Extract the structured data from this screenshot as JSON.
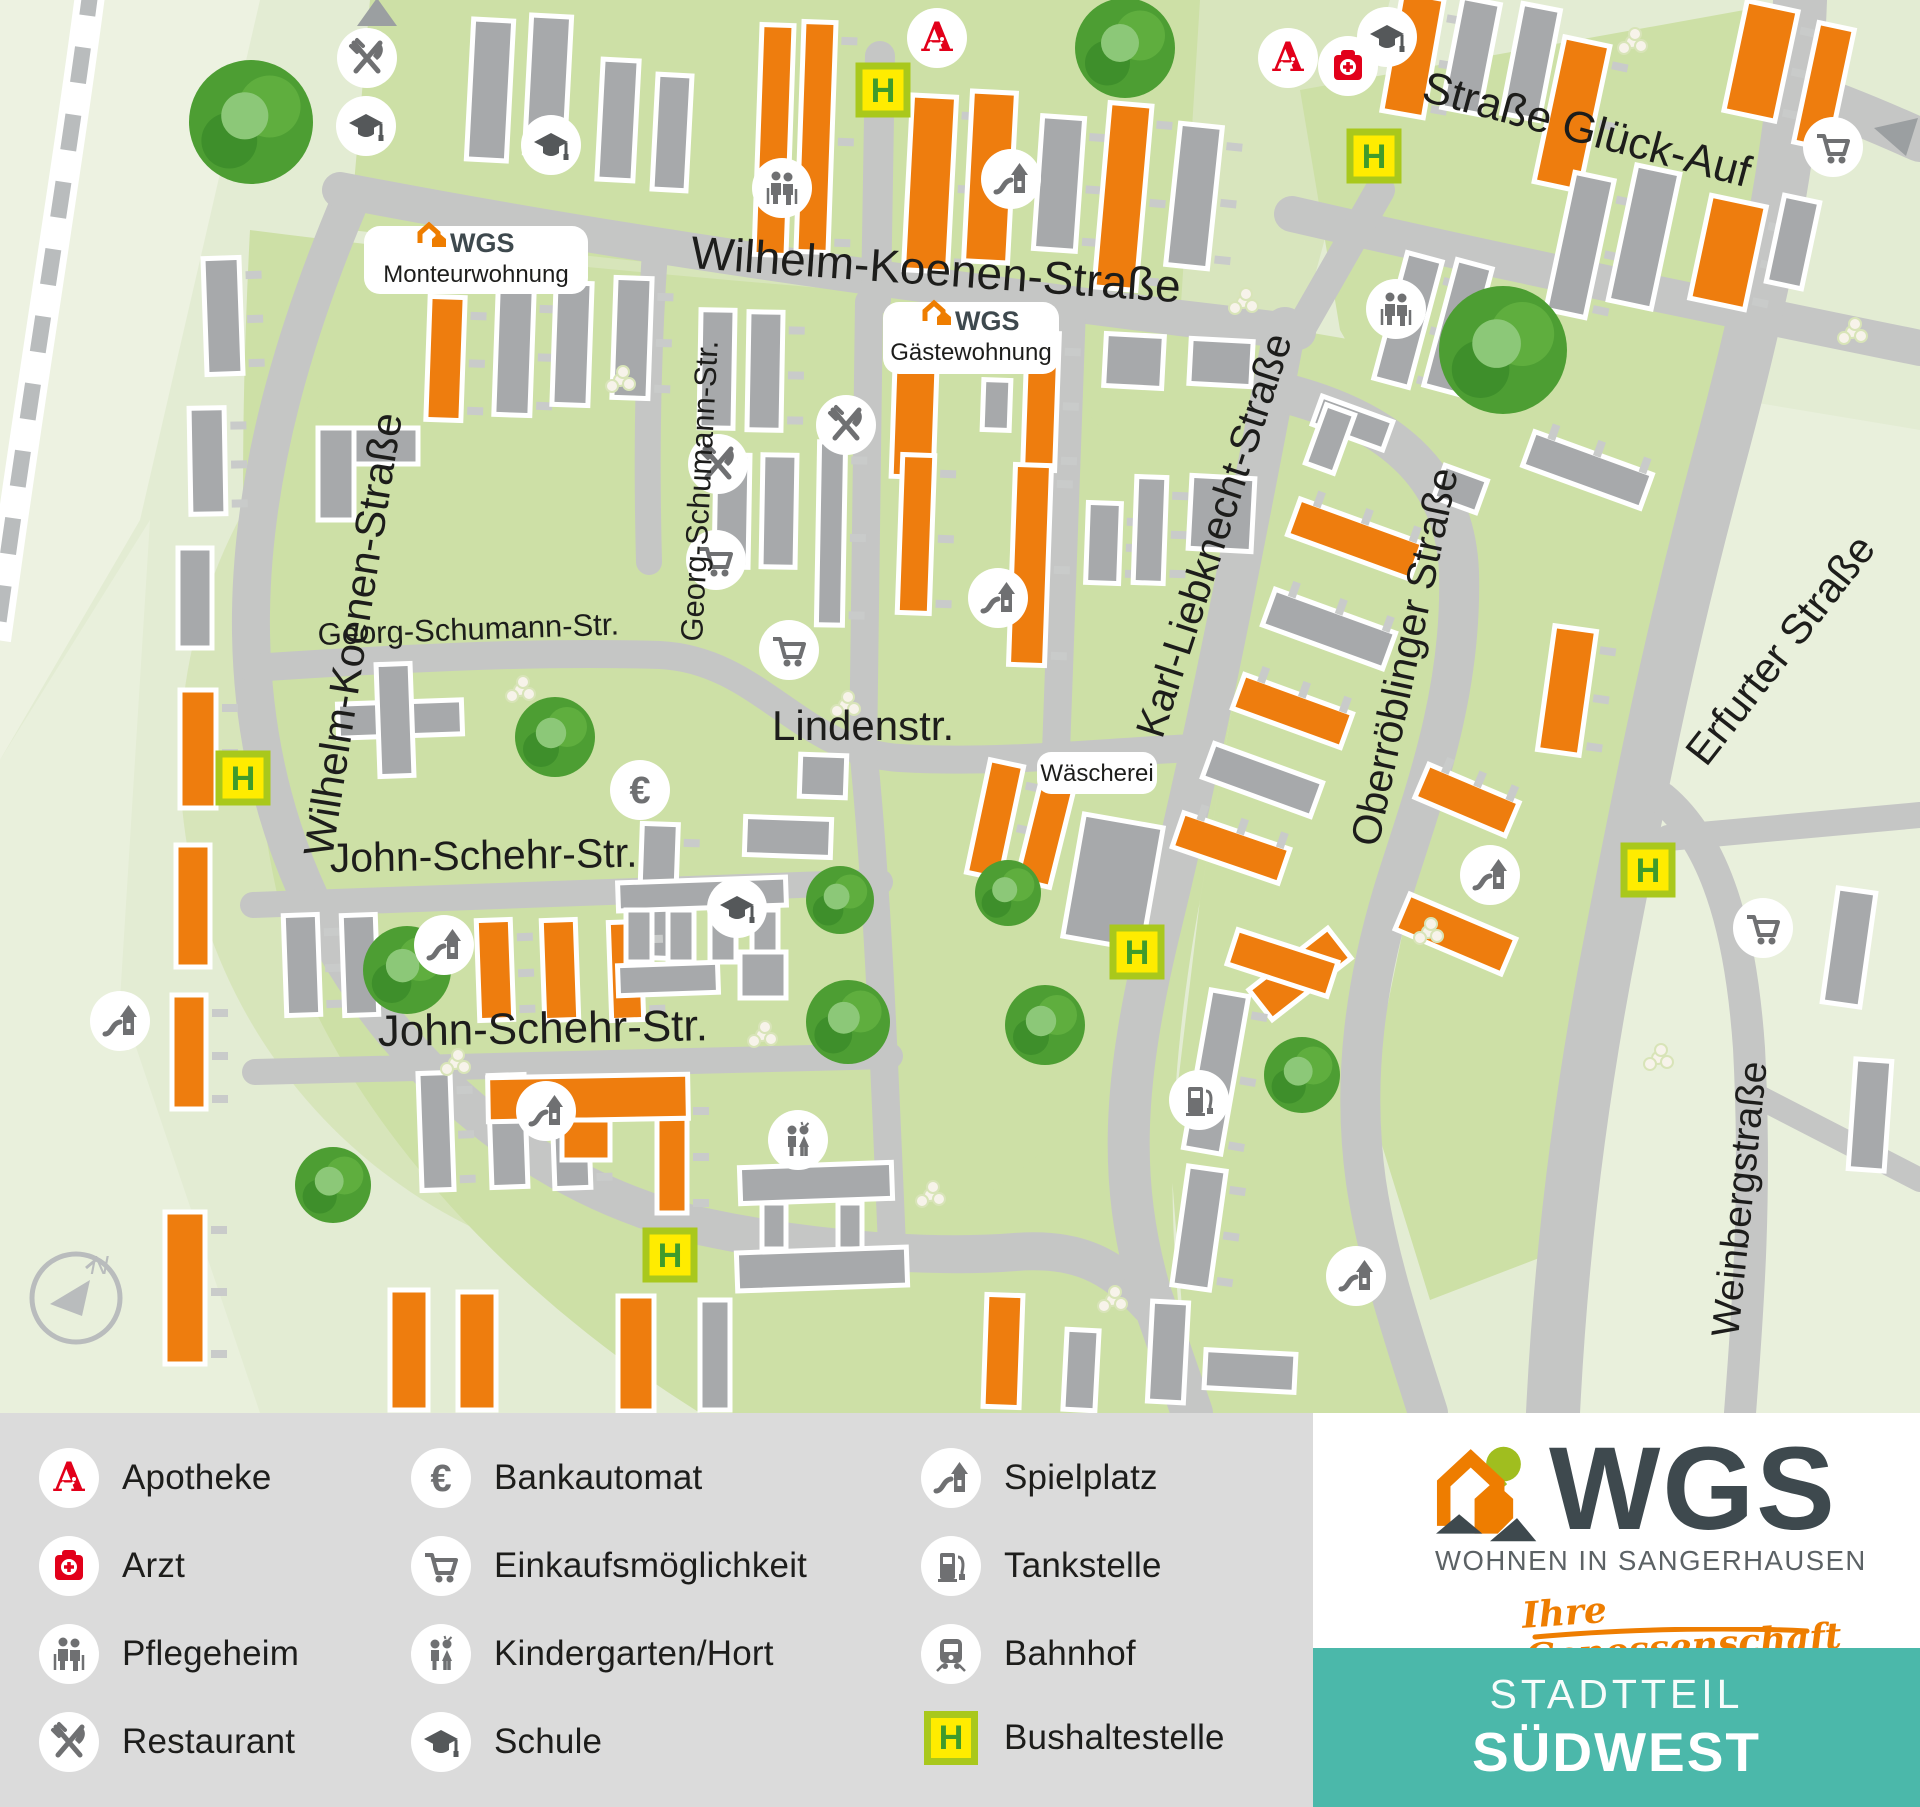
{
  "map": {
    "streets": {
      "wilhelm_koenen": "Wilhelm-Koenen-Straße",
      "strasse_glueck_auf": "Straße Glück-Auf",
      "georg_schumann": "Georg-Schumann-Str.",
      "lindenstr": "Lindenstr.",
      "karl_liebknecht": "Karl-Liebknecht-Straße",
      "oberroeblinger": "Oberröblinger Straße",
      "erfurter": "Erfurter Straße",
      "weinbergstrasse": "Weinbergstraße",
      "john_schehr": "John-Schehr-Str."
    },
    "labels": {
      "wgs_brand": "WGS",
      "monteurwohnung": "Monteurwohnung",
      "gaestewohnung": "Gästewohnung",
      "waescherei": "Wäscherei"
    },
    "compass_n": "N",
    "bus_stop_letter": "H"
  },
  "icons": {
    "euro_glyph": "€",
    "apotheke_glyph": "A"
  },
  "legend": {
    "items": [
      {
        "icon": "apotheke-icon",
        "label": "Apotheke"
      },
      {
        "icon": "arzt-icon",
        "label": "Arzt"
      },
      {
        "icon": "pflegeheim-icon",
        "label": "Pflegeheim"
      },
      {
        "icon": "restaurant-icon",
        "label": "Restaurant"
      },
      {
        "icon": "bankautomat-icon",
        "label": "Bankautomat"
      },
      {
        "icon": "einkaufsmoeglichkeit-icon",
        "label": "Einkaufsmöglichkeit"
      },
      {
        "icon": "kindergarten-icon",
        "label": "Kindergarten/Hort"
      },
      {
        "icon": "schule-icon",
        "label": "Schule"
      },
      {
        "icon": "spielplatz-icon",
        "label": "Spielplatz"
      },
      {
        "icon": "tankstelle-icon",
        "label": "Tankstelle"
      },
      {
        "icon": "bahnhof-icon",
        "label": "Bahnhof"
      },
      {
        "icon": "bushaltestelle-icon",
        "label": "Bushaltestelle"
      }
    ]
  },
  "branding": {
    "logo_text": "WGS",
    "logo_subline": "WOHNEN IN SANGERHAUSEN",
    "logo_claim": "Ihre Genossenschaft",
    "panel_line1": "STADTTEIL",
    "panel_line2": "SÜDWEST"
  },
  "colors": {
    "building_orange": "#ee7d0e",
    "building_gray": "#a7a9ab",
    "road_gray": "#c5c6c5",
    "estate_green": "#cde0a6",
    "base_green": "#e3ecd3",
    "pale_green": "#edf2e1",
    "legend_bg": "#dbdbdb",
    "teal": "#4bb8aa",
    "signal_red": "#e2001a",
    "bus_yellow": "#ffec00",
    "bus_border": "#a9c81c",
    "bus_letter_green": "#3f9b2b",
    "logo_dark": "#3e494e",
    "logo_orange": "#ee7d00"
  }
}
